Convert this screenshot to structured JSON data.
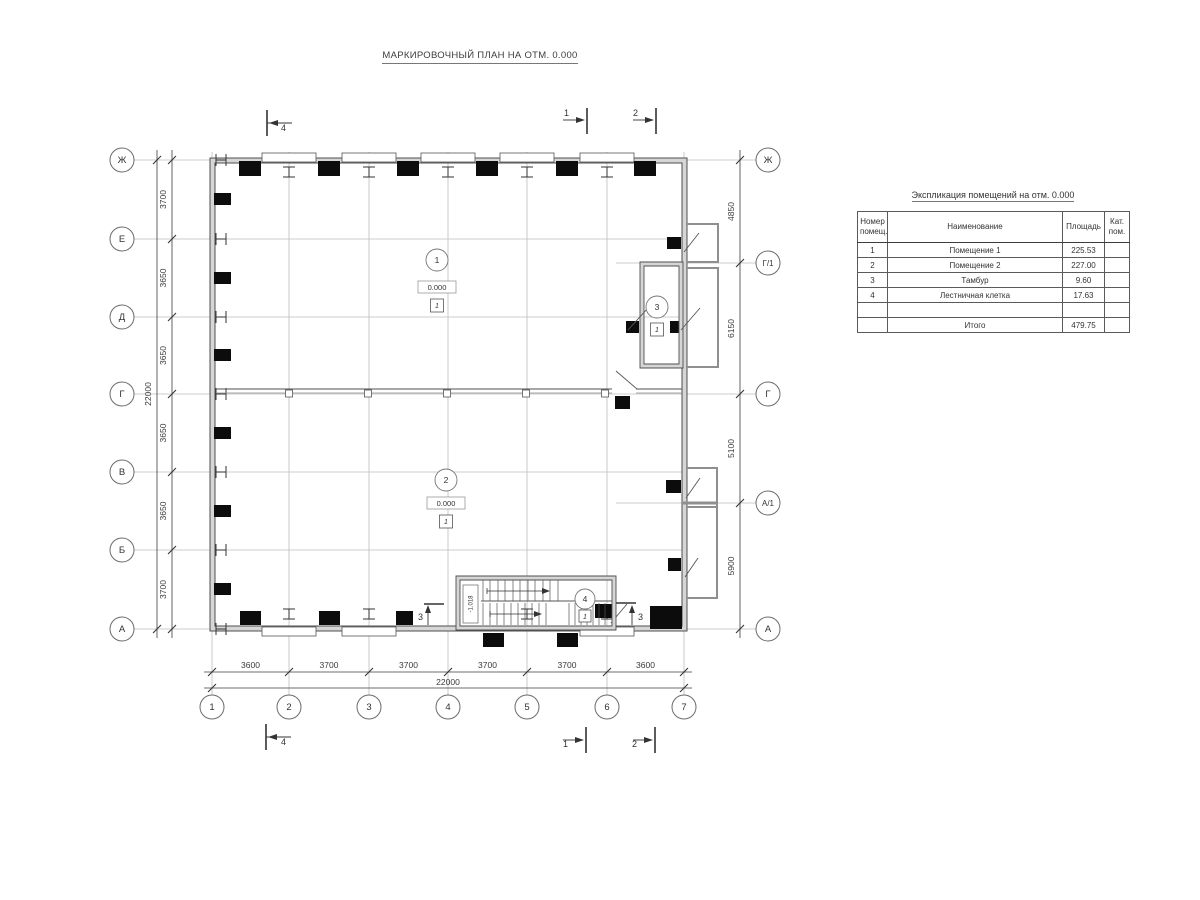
{
  "title": "МАРКИРОВОЧНЫЙ ПЛАН НА ОТМ. 0.000",
  "plan": {
    "axes_left": [
      "Ж",
      "Е",
      "Д",
      "Г",
      "В",
      "Б",
      "А"
    ],
    "axes_right": [
      "Ж",
      "Г/1",
      "Г",
      "А/1",
      "А"
    ],
    "axes_bottom": [
      "1",
      "2",
      "3",
      "4",
      "5",
      "6",
      "7"
    ],
    "dims_left": [
      "3700",
      "3650",
      "3650",
      "3650",
      "3650",
      "3700"
    ],
    "dims_left_total": "22000",
    "dims_right": [
      "4850",
      "6150",
      "5100",
      "5900"
    ],
    "dims_bottom": [
      "3600",
      "3700",
      "3700",
      "3700",
      "3700",
      "3600"
    ],
    "dims_bottom_total": "22000",
    "rooms": [
      {
        "num": "1",
        "elevation": "0.000",
        "floor_type": "1"
      },
      {
        "num": "2",
        "elevation": "0.000",
        "floor_type": "1"
      },
      {
        "num": "3",
        "floor_type": "1"
      },
      {
        "num": "4",
        "floor_type": "1"
      }
    ],
    "stair_elevation": "-1.018",
    "sections": {
      "s1": "1",
      "s2": "2",
      "s3": "3",
      "s4": "4"
    }
  },
  "schedule": {
    "title": "Экспликация помещений на отм. 0.000",
    "headers": [
      "Номер помещ.",
      "Наименование",
      "Площадь",
      "Кат. пом."
    ],
    "rows": [
      {
        "num": "1",
        "name": "Помещение 1",
        "area": "225.53",
        "cat": ""
      },
      {
        "num": "2",
        "name": "Помещение 2",
        "area": "227.00",
        "cat": ""
      },
      {
        "num": "3",
        "name": "Тамбур",
        "area": "9.60",
        "cat": ""
      },
      {
        "num": "4",
        "name": "Лестничная клетка",
        "area": "17.63",
        "cat": ""
      }
    ],
    "total_label": "Итого",
    "total_value": "479.75"
  }
}
